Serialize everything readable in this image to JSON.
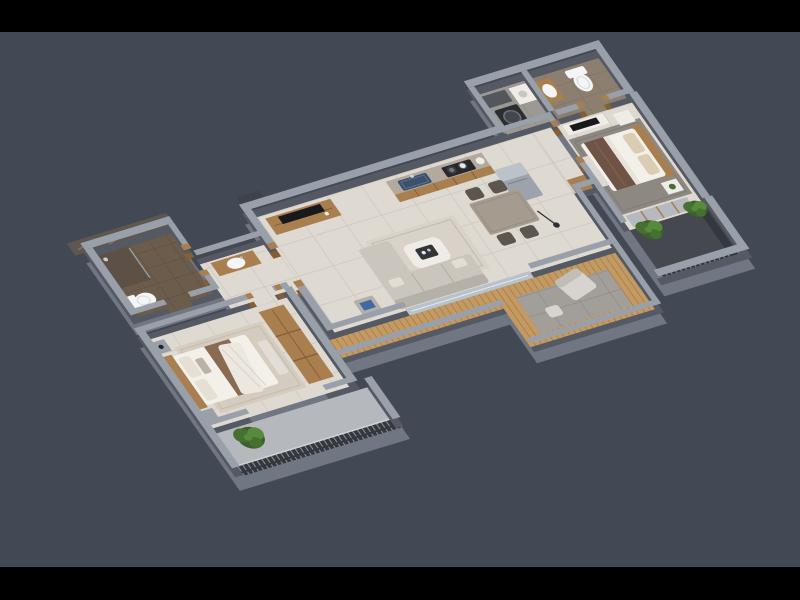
{
  "scene": {
    "type": "3d-floor-plan-render",
    "view": "isometric top-down apartment visualization",
    "unit_type": "2-bedroom apartment with 2 bathrooms, open kitchen, deck and balconies",
    "letterbox": "black bars top and bottom"
  },
  "colors": {
    "background": "#424854",
    "letterbox": "#000000",
    "slab": "#767c87",
    "wall_top": "#9aa0a9",
    "wall_side": "#545963",
    "floor_tile": "#ded9d1",
    "grout": "#ccc6bd",
    "bath_dark_floor": "#6b5c4c",
    "bath_tile_line": "#5a4d3f",
    "bath2_floor": "#8c7f6f",
    "bath2_line": "#7b6f60",
    "utility_floor": "#9c9893",
    "utility_line": "#8a8680",
    "wood": "#a97f50",
    "wood_dark": "#855f33",
    "marble_counter": "#b2aa9e",
    "sink_blue": "#3c516c",
    "stove_dark": "#26282c",
    "appliance_dark": "#2b2d31",
    "fridge": "#9da3ac",
    "fridge_top": "#bcc2c9",
    "tv_black": "#17191d",
    "white_furniture": "#efece7",
    "tray_dark": "#323438",
    "sofa": "#cbc6bd",
    "sofa_back": "#b6b1a8",
    "rug_living": "#d8d2c8",
    "rug_master": "#8e8882",
    "rug_bed2": "#d4ccbe",
    "dining_top": "#a59c8f",
    "chair_dark": "#5d564f",
    "bed_white": "#f3f0e9",
    "pillow_beige": "#dbcdb3",
    "blanket_brown": "#6f5445",
    "blanket_brown2": "#8a6a52",
    "drape_white": "#ece8e0",
    "deck_wood": "#c49a63",
    "deck_slat": "#9a7342",
    "stone": "#a29f9a",
    "stone_line": "#8e8b86",
    "dark_balcony": "#45484e",
    "railing_dark": "#34373d",
    "railing_slat": "#8d939b",
    "balcony2_floor": "#b5b8bc",
    "glass": "#b9c2c9",
    "plant_dark": "#3c5f2b",
    "plant_mid": "#46702f",
    "plant_light": "#578a3a",
    "marble_dark": "#5e5750",
    "marble_vein": "#7d756c",
    "toilet_white": "#f4f5f6",
    "door_dark": "#3e434b"
  },
  "rooms": {
    "living": {
      "label": "Living / Dining",
      "furniture": [
        "L-shaped sofa",
        "coffee table with tray",
        "area rug",
        "side table",
        "dining table",
        "4 dining chairs",
        "TV console"
      ]
    },
    "kitchen": {
      "label": "Open Kitchen",
      "furniture": [
        "counter with marble top",
        "blue sink",
        "gas hob with pots",
        "wooden cabinets",
        "tall refrigerator unit"
      ]
    },
    "utility": {
      "label": "Utility / Wash Area",
      "furniture": [
        "washing machine",
        "counter"
      ]
    },
    "bath_master": {
      "label": "Master Bathroom",
      "furniture": [
        "toilet",
        "washbasin on wooden counter"
      ]
    },
    "bed_master": {
      "label": "Master Bedroom",
      "furniture": [
        "double bed with brown runner",
        "beige pillows",
        "gray rug",
        "white TV console",
        "bedside tables",
        "wardrobe",
        "bench"
      ]
    },
    "balcony_master": {
      "label": "Master Balcony",
      "furniture": [
        "dark railing",
        "two green plants"
      ]
    },
    "deck": {
      "label": "Deck / Terrace",
      "furniture": [
        "wooden slat walkway",
        "stone tile terrace",
        "lounge chair",
        "footstool"
      ]
    },
    "passage": {
      "label": "Passage",
      "furniture": [
        "washbasin counter"
      ]
    },
    "bath_common": {
      "label": "Common Bathroom",
      "furniture": [
        "toilet",
        "shower area",
        "marble clad exterior wall"
      ]
    },
    "bed_second": {
      "label": "Second Bedroom",
      "furniture": [
        "double bed with draped blanket",
        "bedside tables",
        "bench",
        "wooden wardrobe",
        "beige rug"
      ]
    },
    "balcony_second": {
      "label": "Second Balcony",
      "furniture": [
        "slatted railing",
        "green plant"
      ]
    }
  }
}
